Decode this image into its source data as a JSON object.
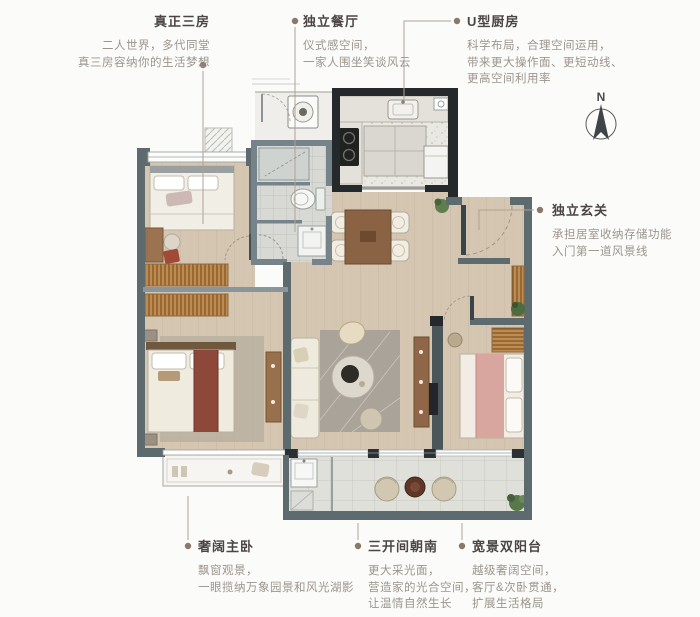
{
  "page": {
    "background": "#fbfbfa"
  },
  "compass": {
    "label": "N"
  },
  "callouts": {
    "three_rooms": {
      "title": "真正三房",
      "lines": [
        "二人世界，多代同堂",
        "真三房容纳你的生活梦想"
      ]
    },
    "dining": {
      "title": "独立餐厅",
      "lines": [
        "仪式感空间，",
        "一家人围坐笑谈风云"
      ]
    },
    "kitchen": {
      "title": "U型厨房",
      "lines": [
        "科学布局，合理空间运用，",
        "带来更大操作面、更短动线、",
        "更高空间利用率"
      ]
    },
    "foyer": {
      "title": "独立玄关",
      "lines": [
        "承担居室收纳存储功能",
        "入门第一道风景线"
      ]
    },
    "master": {
      "title": "奢阔主卧",
      "lines": [
        "飘窗观景，",
        "一眼揽纳万象园景和风光湖影"
      ]
    },
    "south_facing": {
      "title": "三开间朝南",
      "lines": [
        "更大采光面，",
        "营造家的光合空间，",
        "让温情自然生长"
      ]
    },
    "balcony": {
      "title": "宽景双阳台",
      "lines": [
        "越级奢阔空间，",
        "客厅&次卧贯通，",
        "扩展生活格局"
      ]
    }
  },
  "colors": {
    "wall_dark": "#25292c",
    "wall_gray": "#5d6a6e",
    "wood_floor": "#d5c6b1",
    "wardrobe_wood": "#bd8c52",
    "leader_line": "#b0a295",
    "title_text": "#4b4643",
    "body_text": "#9c958e",
    "bed_runner_red": "#8d4839",
    "bed_pink": "#d8a69e"
  }
}
